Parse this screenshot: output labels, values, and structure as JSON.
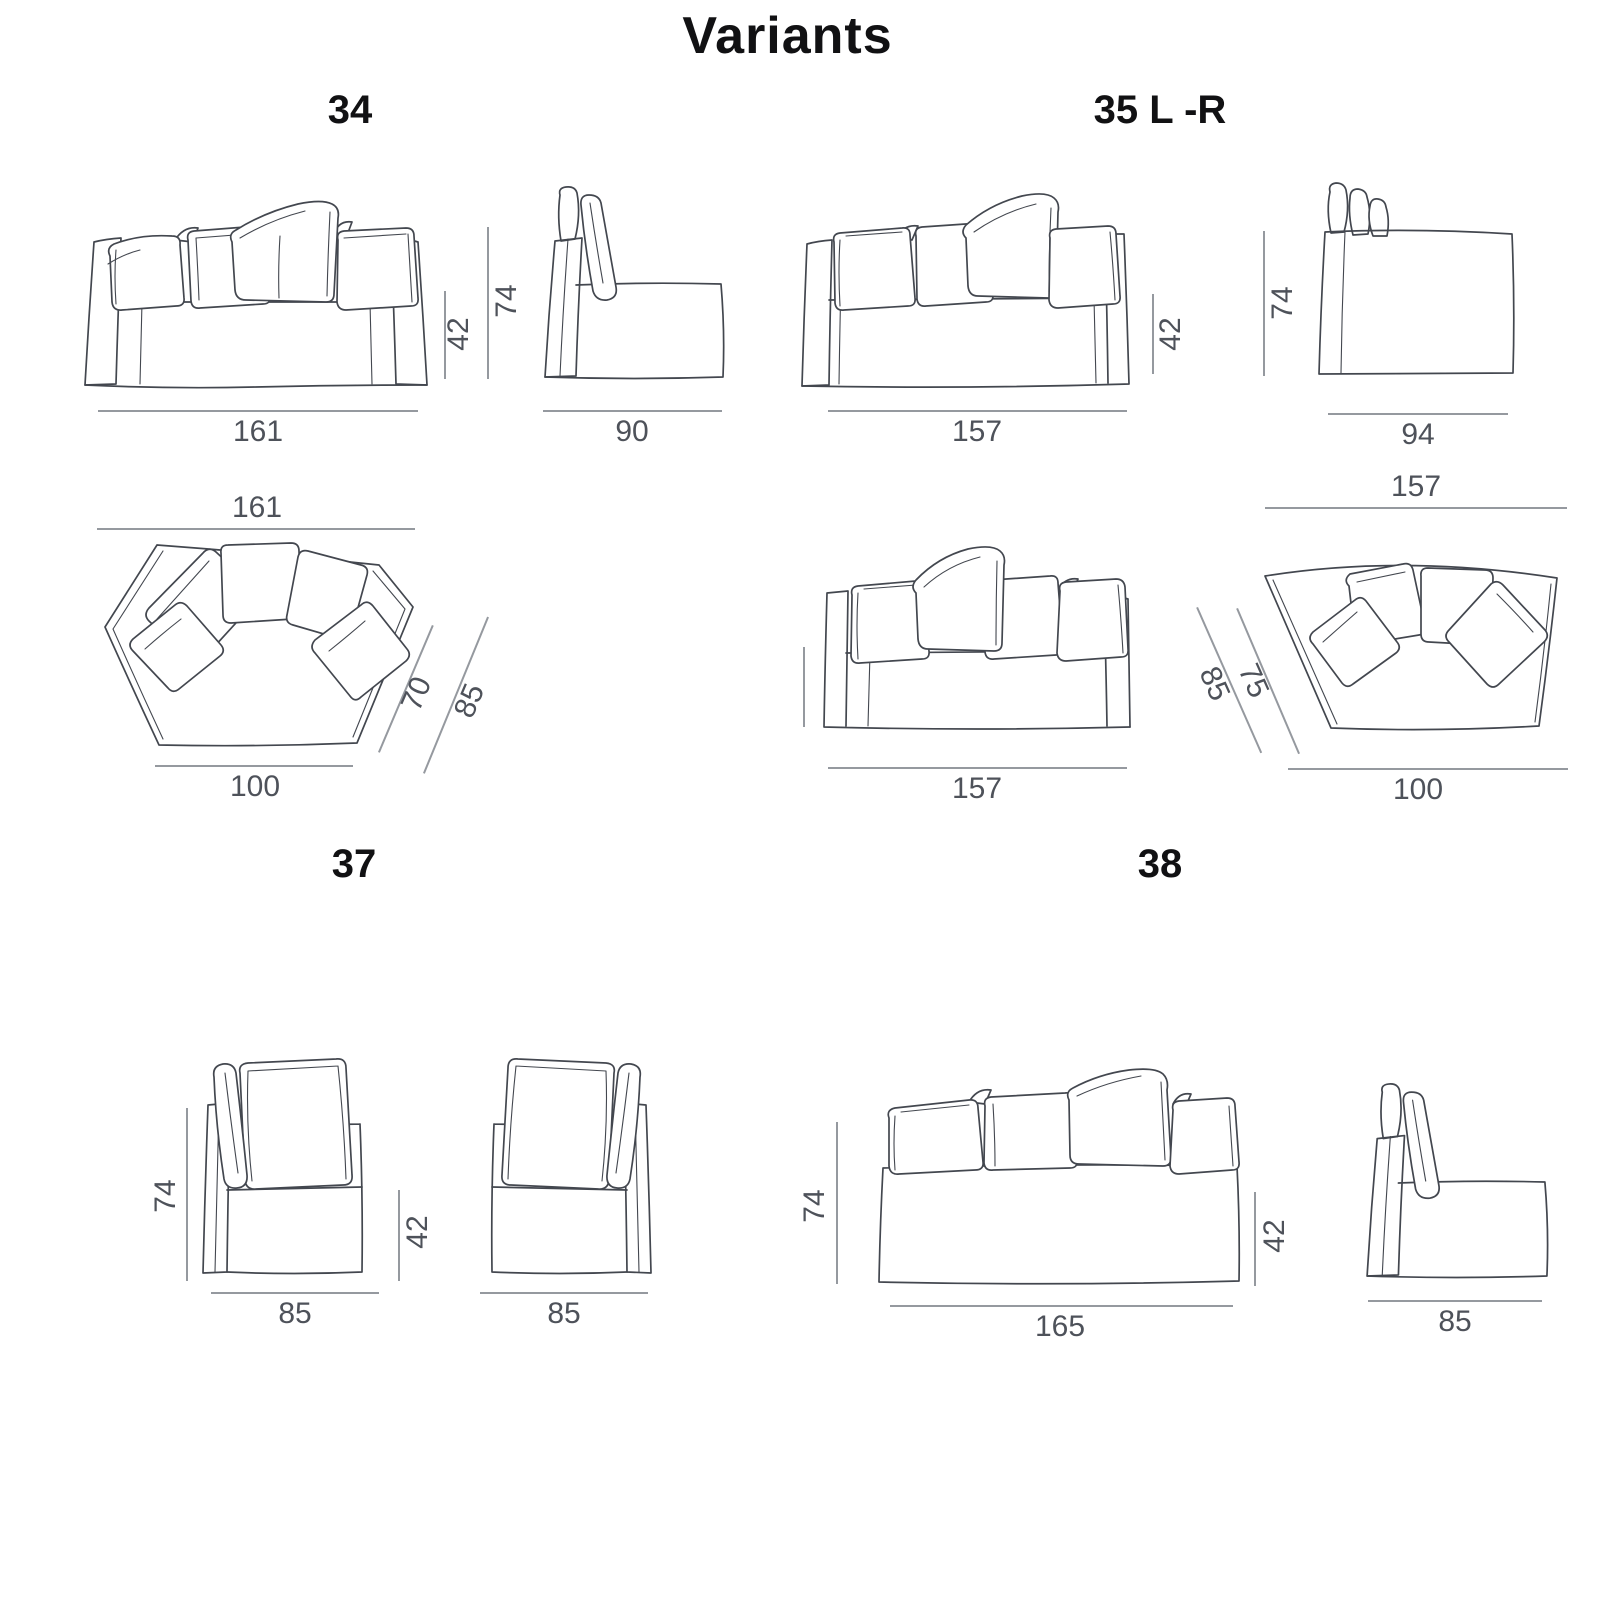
{
  "page": {
    "title": "Variants",
    "colors": {
      "ink": "#111113",
      "sketch": "#43474f",
      "dim_line": "#95999f",
      "dim_text": "#4e525a",
      "background": "#ffffff"
    }
  },
  "sections": {
    "s34": {
      "label": "34",
      "dims": {
        "front_width": "161",
        "seat_height": "42",
        "total_height": "74",
        "side_depth": "90",
        "top_width": "161",
        "top_front_width": "100",
        "top_depth_inner": "70",
        "top_depth_outer": "85"
      }
    },
    "s35": {
      "label": "35 L -R",
      "dims": {
        "front_width": "157",
        "seat_height": "42",
        "total_height": "74",
        "side_depth": "94",
        "front2_width": "157",
        "top_width": "157",
        "top_depth_outer": "85",
        "top_depth_inner": "75",
        "top_front_width": "100"
      }
    },
    "s37": {
      "label": "37",
      "dims": {
        "total_height": "74",
        "seat_height": "42",
        "left_width": "85",
        "right_width": "85"
      }
    },
    "s38": {
      "label": "38",
      "dims": {
        "total_height": "74",
        "seat_height": "42",
        "front_width": "165",
        "side_depth": "85"
      }
    }
  }
}
